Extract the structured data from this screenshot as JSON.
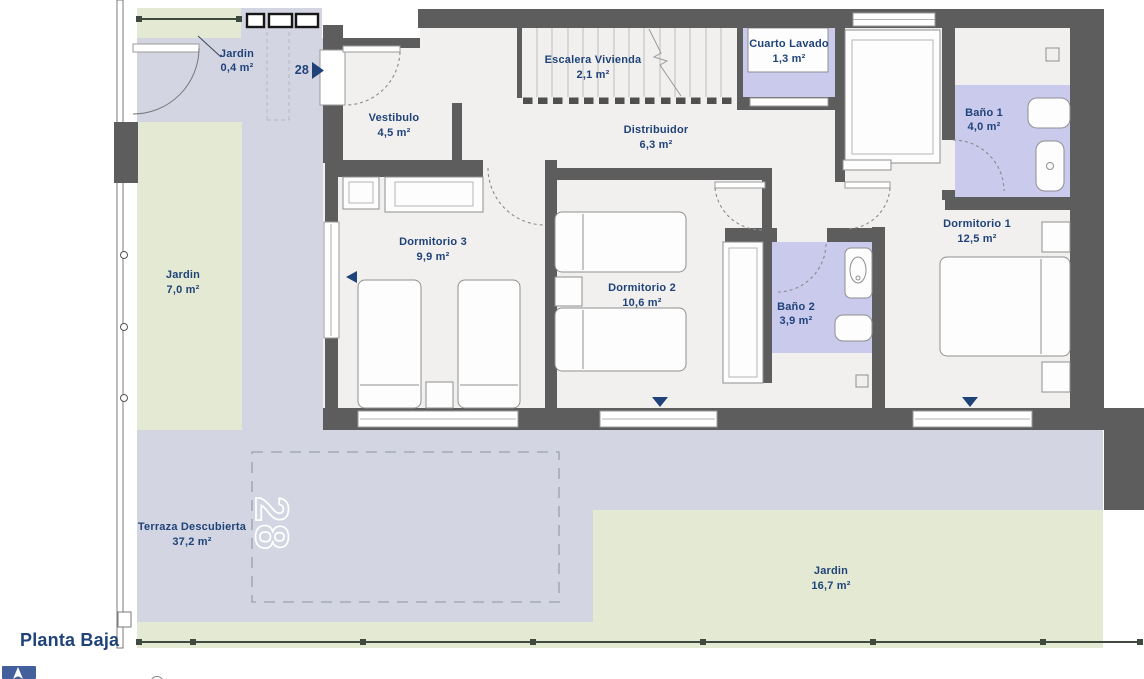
{
  "plan": {
    "title": "Planta Baja",
    "unit_number": "28",
    "watermark": "28"
  },
  "rooms": {
    "jardin_entrada": {
      "name": "Jardin",
      "area": "0,4 m²"
    },
    "vestibulo": {
      "name": "Vestibulo",
      "area": "4,5 m²"
    },
    "escalera": {
      "name": "Escalera Vivienda",
      "area": "2,1 m²"
    },
    "cuarto_lavado": {
      "name": "Cuarto Lavado",
      "area": "1,3 m²"
    },
    "distribuidor": {
      "name": "Distribuidor",
      "area": "6,3 m²"
    },
    "bano1": {
      "name": "Baño 1",
      "area": "4,0 m²"
    },
    "dormitorio1": {
      "name": "Dormitorio 1",
      "area": "12,5 m²"
    },
    "dormitorio3": {
      "name": "Dormitorio 3",
      "area": "9,9 m²"
    },
    "dormitorio2": {
      "name": "Dormitorio 2",
      "area": "10,6 m²"
    },
    "bano2": {
      "name": "Baño 2",
      "area": "3,9 m²"
    },
    "jardin_lateral": {
      "name": "Jardin",
      "area": "7,0 m²"
    },
    "terraza": {
      "name": "Terraza Descubierta",
      "area": "37,2 m²"
    },
    "jardin_trasero": {
      "name": "Jardin",
      "area": "16,7 m²"
    }
  },
  "colors": {
    "wall": "#5d5d5d",
    "floor": "#f1f0ee",
    "bathroom": "#c9caec",
    "garden": "#e4e9d3",
    "terrace": "#d3d6e2",
    "label_text": "#1f4379",
    "fence": "#3d4a3d",
    "north_icon_blue": "#43609c"
  },
  "icons": {
    "north_arrow": "north-arrow-icon",
    "unit_direction": "right-arrow-icon",
    "terrace_access": "down-arrow-icon",
    "side_access": "left-arrow-icon"
  }
}
